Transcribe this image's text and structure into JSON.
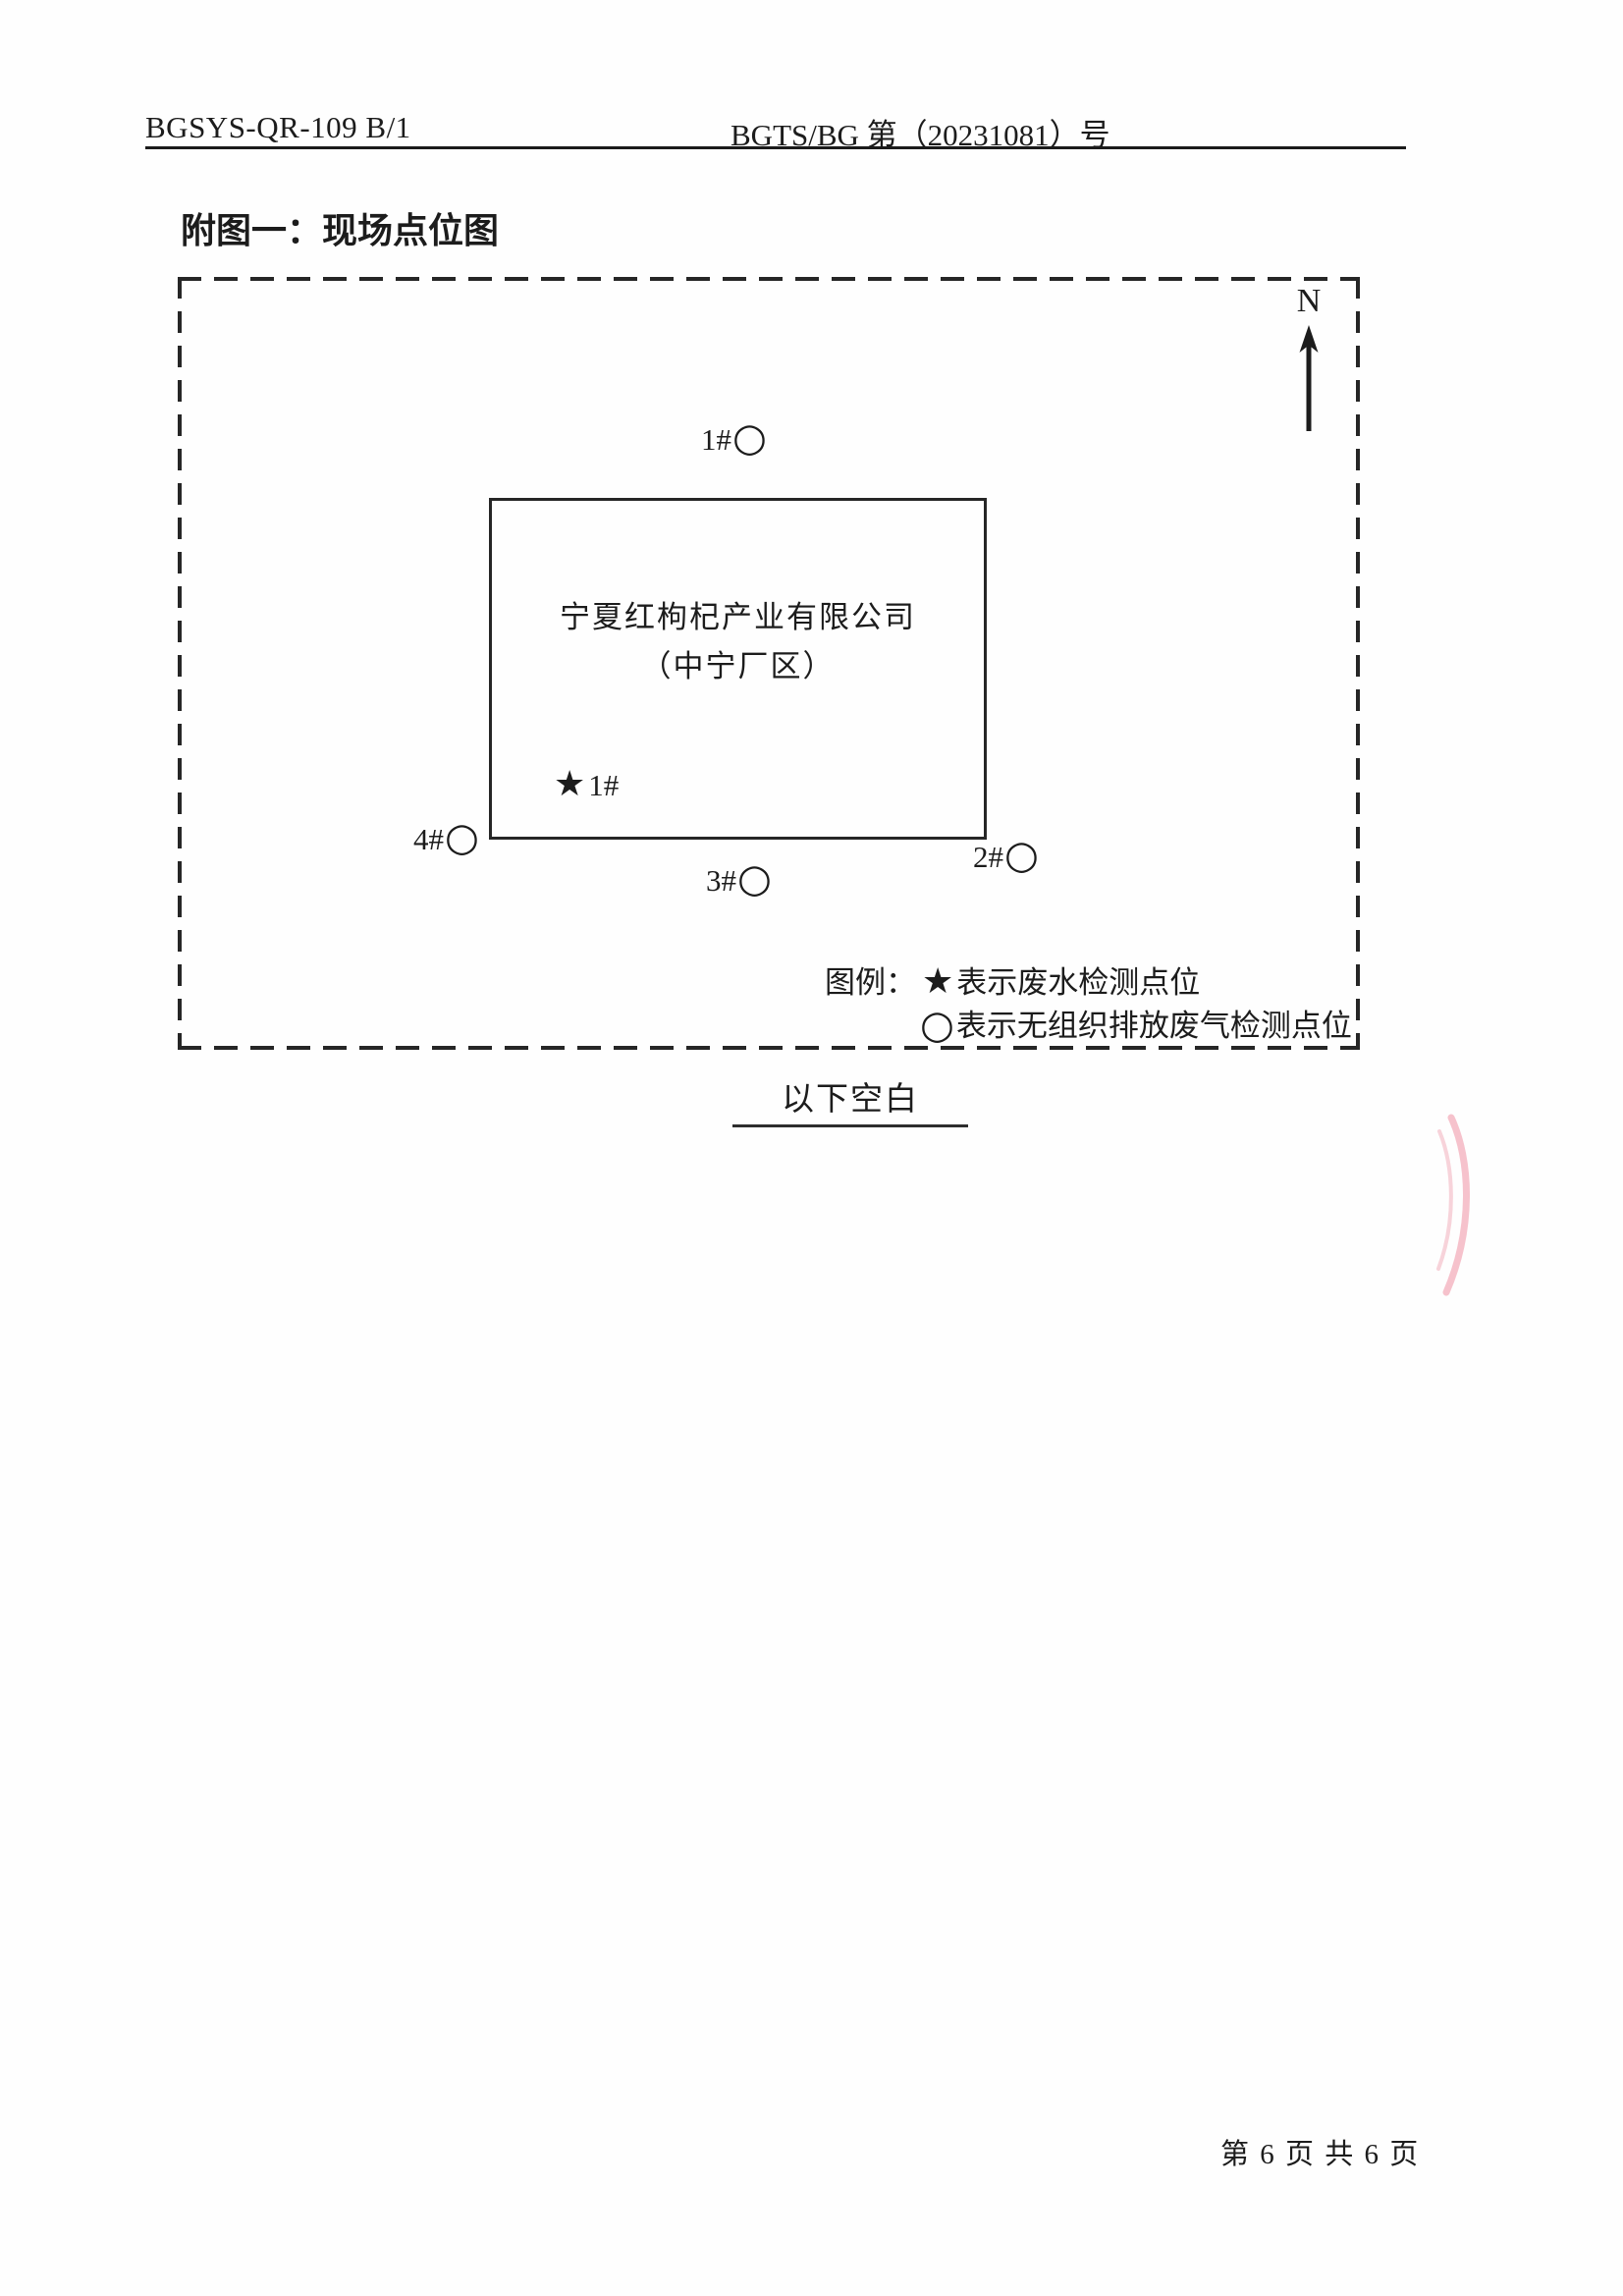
{
  "header": {
    "left": "BGSYS-QR-109 B/1",
    "right": "BGTS/BG 第（20231081）号"
  },
  "title": "附图一：现场点位图",
  "map": {
    "north_label": "N",
    "company_line1": "宁夏红枸杞产业有限公司",
    "company_line2": "（中宁厂区）",
    "points": {
      "p1": {
        "label": "1#",
        "symbol": "○"
      },
      "p2": {
        "label": "2#",
        "symbol": "○"
      },
      "p3": {
        "label": "3#",
        "symbol": "○"
      },
      "p4": {
        "label": "4#",
        "symbol": "○"
      },
      "wastewater": {
        "symbol": "★",
        "label": "1#"
      }
    },
    "legend": {
      "title": "图例：",
      "line1_symbol": "★",
      "line1_text": "表示废水检测点位",
      "line2_symbol": "○",
      "line2_text": "表示无组织排放废气检测点位"
    }
  },
  "below_blank": "以下空白",
  "footer": {
    "page_text": "第 6 页 共 6 页"
  },
  "colors": {
    "ink": "#1c1c1c",
    "stamp_pink": "#ee8fa2"
  }
}
